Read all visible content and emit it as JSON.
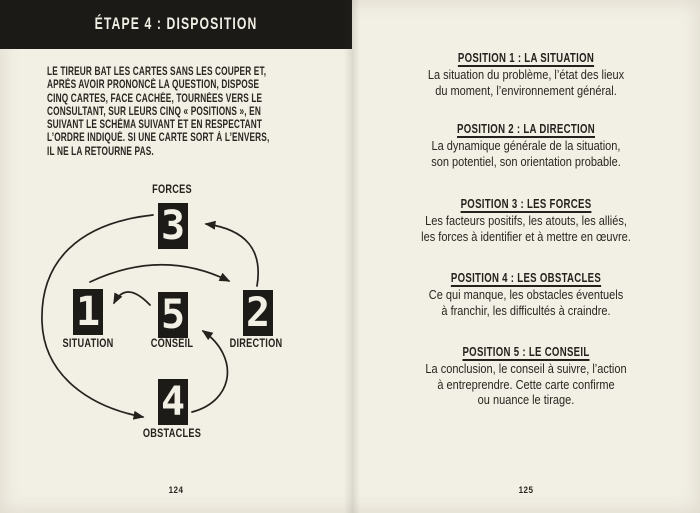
{
  "palette": {
    "paper": "#f2efe4",
    "ink": "#2a2622",
    "banner_bg": "#1b1a17",
    "banner_text": "#f1eee3"
  },
  "left_page": {
    "banner_title": "ÉTAPE 4 : DISPOSITION",
    "intro_lines": [
      "LE TIREUR BAT LES CARTES SANS LES COUPER ET,",
      "APRÈS AVOIR PRONONCÉ LA QUESTION, DISPOSE",
      "CINQ CARTES, FACE CACHÉE, TOURNÉES VERS LE",
      "CONSULTANT, SUR LEURS CINQ « POSITIONS », EN",
      "SUIVANT LE SCHÉMA SUIVANT ET EN RESPECTANT",
      "L’ORDRE INDIQUÉ. SI UNE CARTE SORT À L’ENVERS,",
      "IL NE LA RETOURNE PAS."
    ],
    "page_number": "124"
  },
  "diagram": {
    "cards": [
      {
        "number": "1",
        "label": "SITUATION"
      },
      {
        "number": "2",
        "label": "DIRECTION"
      },
      {
        "number": "3",
        "label": "FORCES"
      },
      {
        "number": "4",
        "label": "OBSTACLES"
      },
      {
        "number": "5",
        "label": "CONSEIL"
      }
    ],
    "arrows": [
      {
        "from": "1",
        "to": "2"
      },
      {
        "from": "2",
        "to": "3"
      },
      {
        "from": "3",
        "to": "4"
      },
      {
        "from": "4",
        "to": "5"
      },
      {
        "from": "5",
        "to": "1"
      }
    ]
  },
  "right_page": {
    "sections": [
      {
        "heading": "POSITION 1 : LA SITUATION",
        "lines": [
          "La situation du problème, l’état des lieux",
          "du moment, l’environnement général."
        ]
      },
      {
        "heading": "POSITION 2 : LA DIRECTION",
        "lines": [
          "La dynamique générale de la situation,",
          "son potentiel, son orientation probable."
        ]
      },
      {
        "heading": "POSITION 3 : LES FORCES",
        "lines": [
          "Les facteurs positifs, les atouts, les alliés,",
          "les forces à identifier et à mettre en œuvre."
        ]
      },
      {
        "heading": "POSITION 4 : LES OBSTACLES",
        "lines": [
          "Ce qui manque, les obstacles éventuels",
          "à franchir, les difficultés à craindre."
        ]
      },
      {
        "heading": "POSITION 5 : LE CONSEIL",
        "lines": [
          "La conclusion, le conseil à suivre, l’action",
          "à entreprendre. Cette carte confirme",
          "ou nuance le tirage."
        ]
      }
    ],
    "page_number": "125"
  }
}
